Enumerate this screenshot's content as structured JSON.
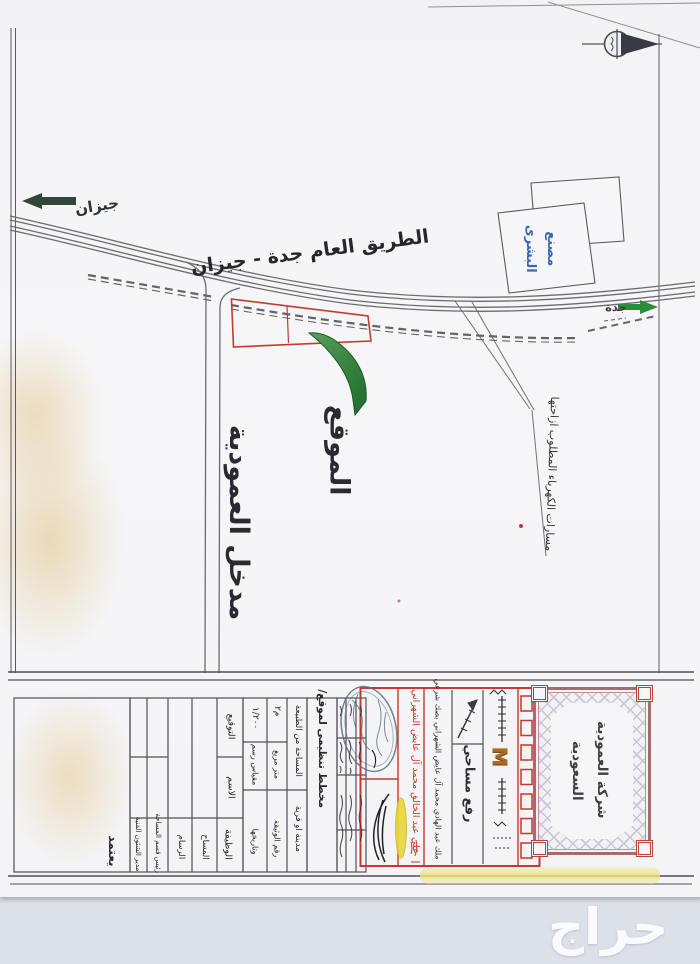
{
  "page": {
    "background_color": "#dce0e8",
    "paper_color": "#f4f4f7",
    "red_accent": "#c23b2e",
    "green_accent": "#2d7a33",
    "blue_ink": "#3a66b8"
  },
  "map": {
    "highway_label": "الطريق العام جدة - جيزان",
    "direction_west_label": "جيزان",
    "direction_east_label": "جدة",
    "factory_label_line1": "مصنع",
    "factory_label_line2": "البشرى",
    "location_label": "الموقع",
    "entrance_label": "مدخل العمودية",
    "powerline_note": "مسارات الكهرباء المطلوب ازاحتها"
  },
  "titleblock": {
    "approve_label": "يعتمد",
    "signature_table": {
      "row_labels": [
        "التوقيع",
        "الاسم",
        "الوظيفة"
      ],
      "positions": [
        "مدير الشئون الفنية",
        "رئيس قسم المساحة",
        "الرسام",
        "المساح"
      ]
    },
    "fields": {
      "scale_value": "١/٢٠٠",
      "scale_label": "مقياس رسم",
      "area_value_unit": "م٢",
      "area_unit_label": "متر مربع",
      "area_label": "المساحة من الطبيعة",
      "city_label": "مدينة او قرية",
      "doc_number_label": "رقم الوثيقة",
      "doc_date_label": "وتاريخها",
      "plan_title": "مخطط تنظيمى لموقع/"
    },
    "red_box": {
      "owner_name_red": "علي عبد الخالق محمد آل عايض الشهراني",
      "deed_note": "ملك عبد الهادي محمد آل عايض الشهراني بصك شرعي",
      "survey_label": "رفع مساحي",
      "monogram": "M"
    },
    "company_box": {
      "line1": "شركة العمودية",
      "line2": "السعودية"
    }
  },
  "watermark_label": "حراج"
}
